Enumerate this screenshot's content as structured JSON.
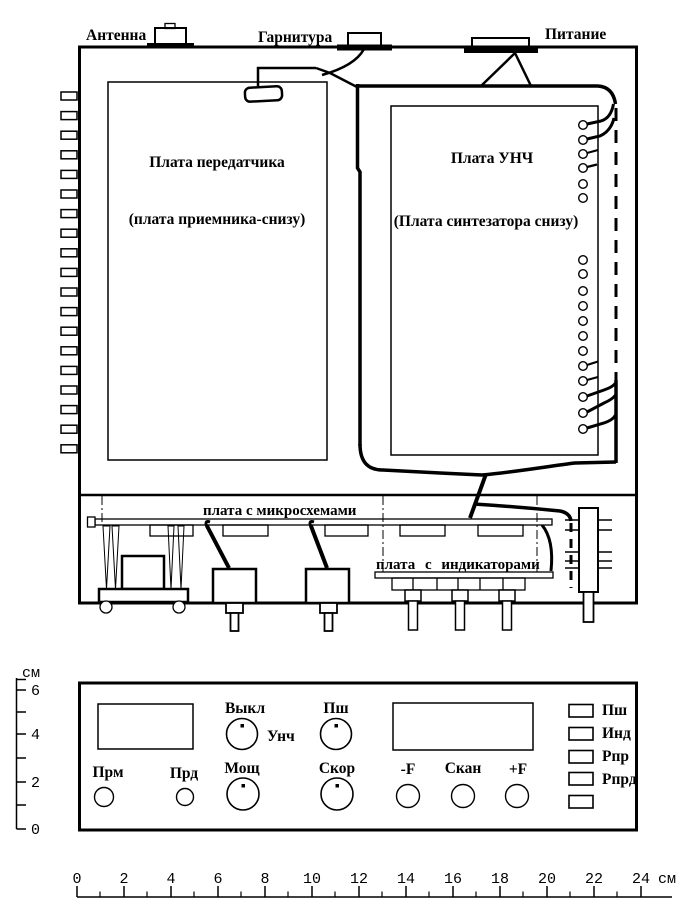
{
  "connectors": {
    "antenna": "Антенна",
    "headset": "Гарнитура",
    "power": "Питание"
  },
  "boards": {
    "transmitter_title": "Плата передатчика",
    "transmitter_subtitle": "(плата приемника-снизу)",
    "unch_title": "Плата УНЧ",
    "unch_subtitle": "(Плата синтезатора снизу)"
  },
  "chassis_bottom": {
    "chips_board_label": "плата с микросхемами",
    "indicator_board_label": "плата с индикаторами"
  },
  "front_panel": {
    "knob_volume_label": "Выкл",
    "knob_volume_side_label": "Унч",
    "knob_squelch_label": "Пш",
    "led_rx_label": "Прм",
    "led_tx_label": "Прд",
    "knob_power_label": "Мощ",
    "knob_speed_label": "Скор",
    "btn_freq_down_label": "-F",
    "btn_scan_label": "Скан",
    "btn_freq_up_label": "+F",
    "legend": [
      {
        "label": "Пш"
      },
      {
        "label": "Инд"
      },
      {
        "label": "Рпр"
      },
      {
        "label": "Рпрд"
      },
      {
        "label": ""
      }
    ]
  },
  "rulers": {
    "unit": "см",
    "vertical_labels": [
      "6",
      "4",
      "2",
      "0"
    ],
    "horizontal_labels": [
      "0",
      "2",
      "4",
      "6",
      "8",
      "10",
      "12",
      "14",
      "16",
      "18",
      "20",
      "22",
      "24"
    ]
  },
  "colors": {
    "ink": "#000000",
    "background": "#ffffff"
  }
}
